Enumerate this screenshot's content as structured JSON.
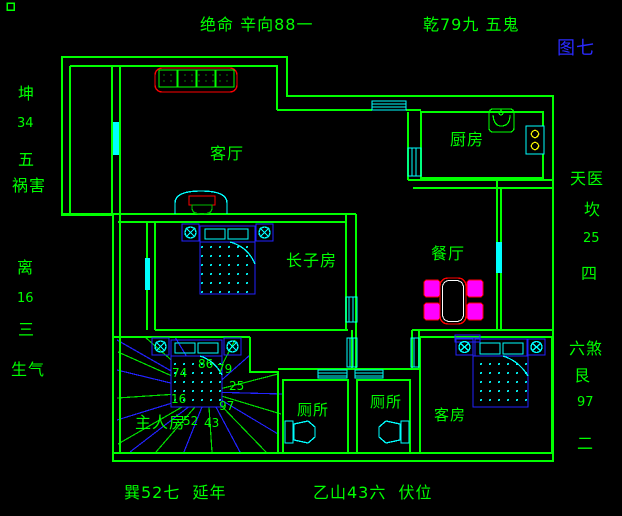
{
  "colors": {
    "background": "#000000",
    "wall_green": "#00FF00",
    "fixture_cyan": "#00FFFF",
    "furniture_blue": "#2222FF",
    "accent_red": "#FF0000",
    "chair_magenta": "#FF00FF",
    "stove_yellow": "#FFFF00",
    "figure_blue": "#2A2AFF"
  },
  "compass": {
    "top": "绝命 辛向88一",
    "top_right": "乾79九 五鬼",
    "figure_no": "图七",
    "left": [
      "坤",
      "34",
      "五",
      "祸害",
      "离",
      "16",
      "三",
      "生气"
    ],
    "right": [
      "天医",
      "坎",
      "25",
      "四",
      "六煞",
      "艮",
      "97",
      "二"
    ],
    "bottom_left": "巽52七  延年",
    "bottom_right": "乙山43六  伏位"
  },
  "rooms": {
    "living": "客厅",
    "kitchen": "厨房",
    "dining": "餐厅",
    "eldest_son": "长子房",
    "master": "主人房",
    "toilet_left": "厕所",
    "toilet_right": "厕所",
    "guest": "客房"
  },
  "fan_numbers": {
    "n74": "74",
    "n86": "86",
    "n79": "79",
    "n25": "25",
    "n16": "16",
    "n97": "97",
    "n52": "52",
    "n43": "43"
  }
}
